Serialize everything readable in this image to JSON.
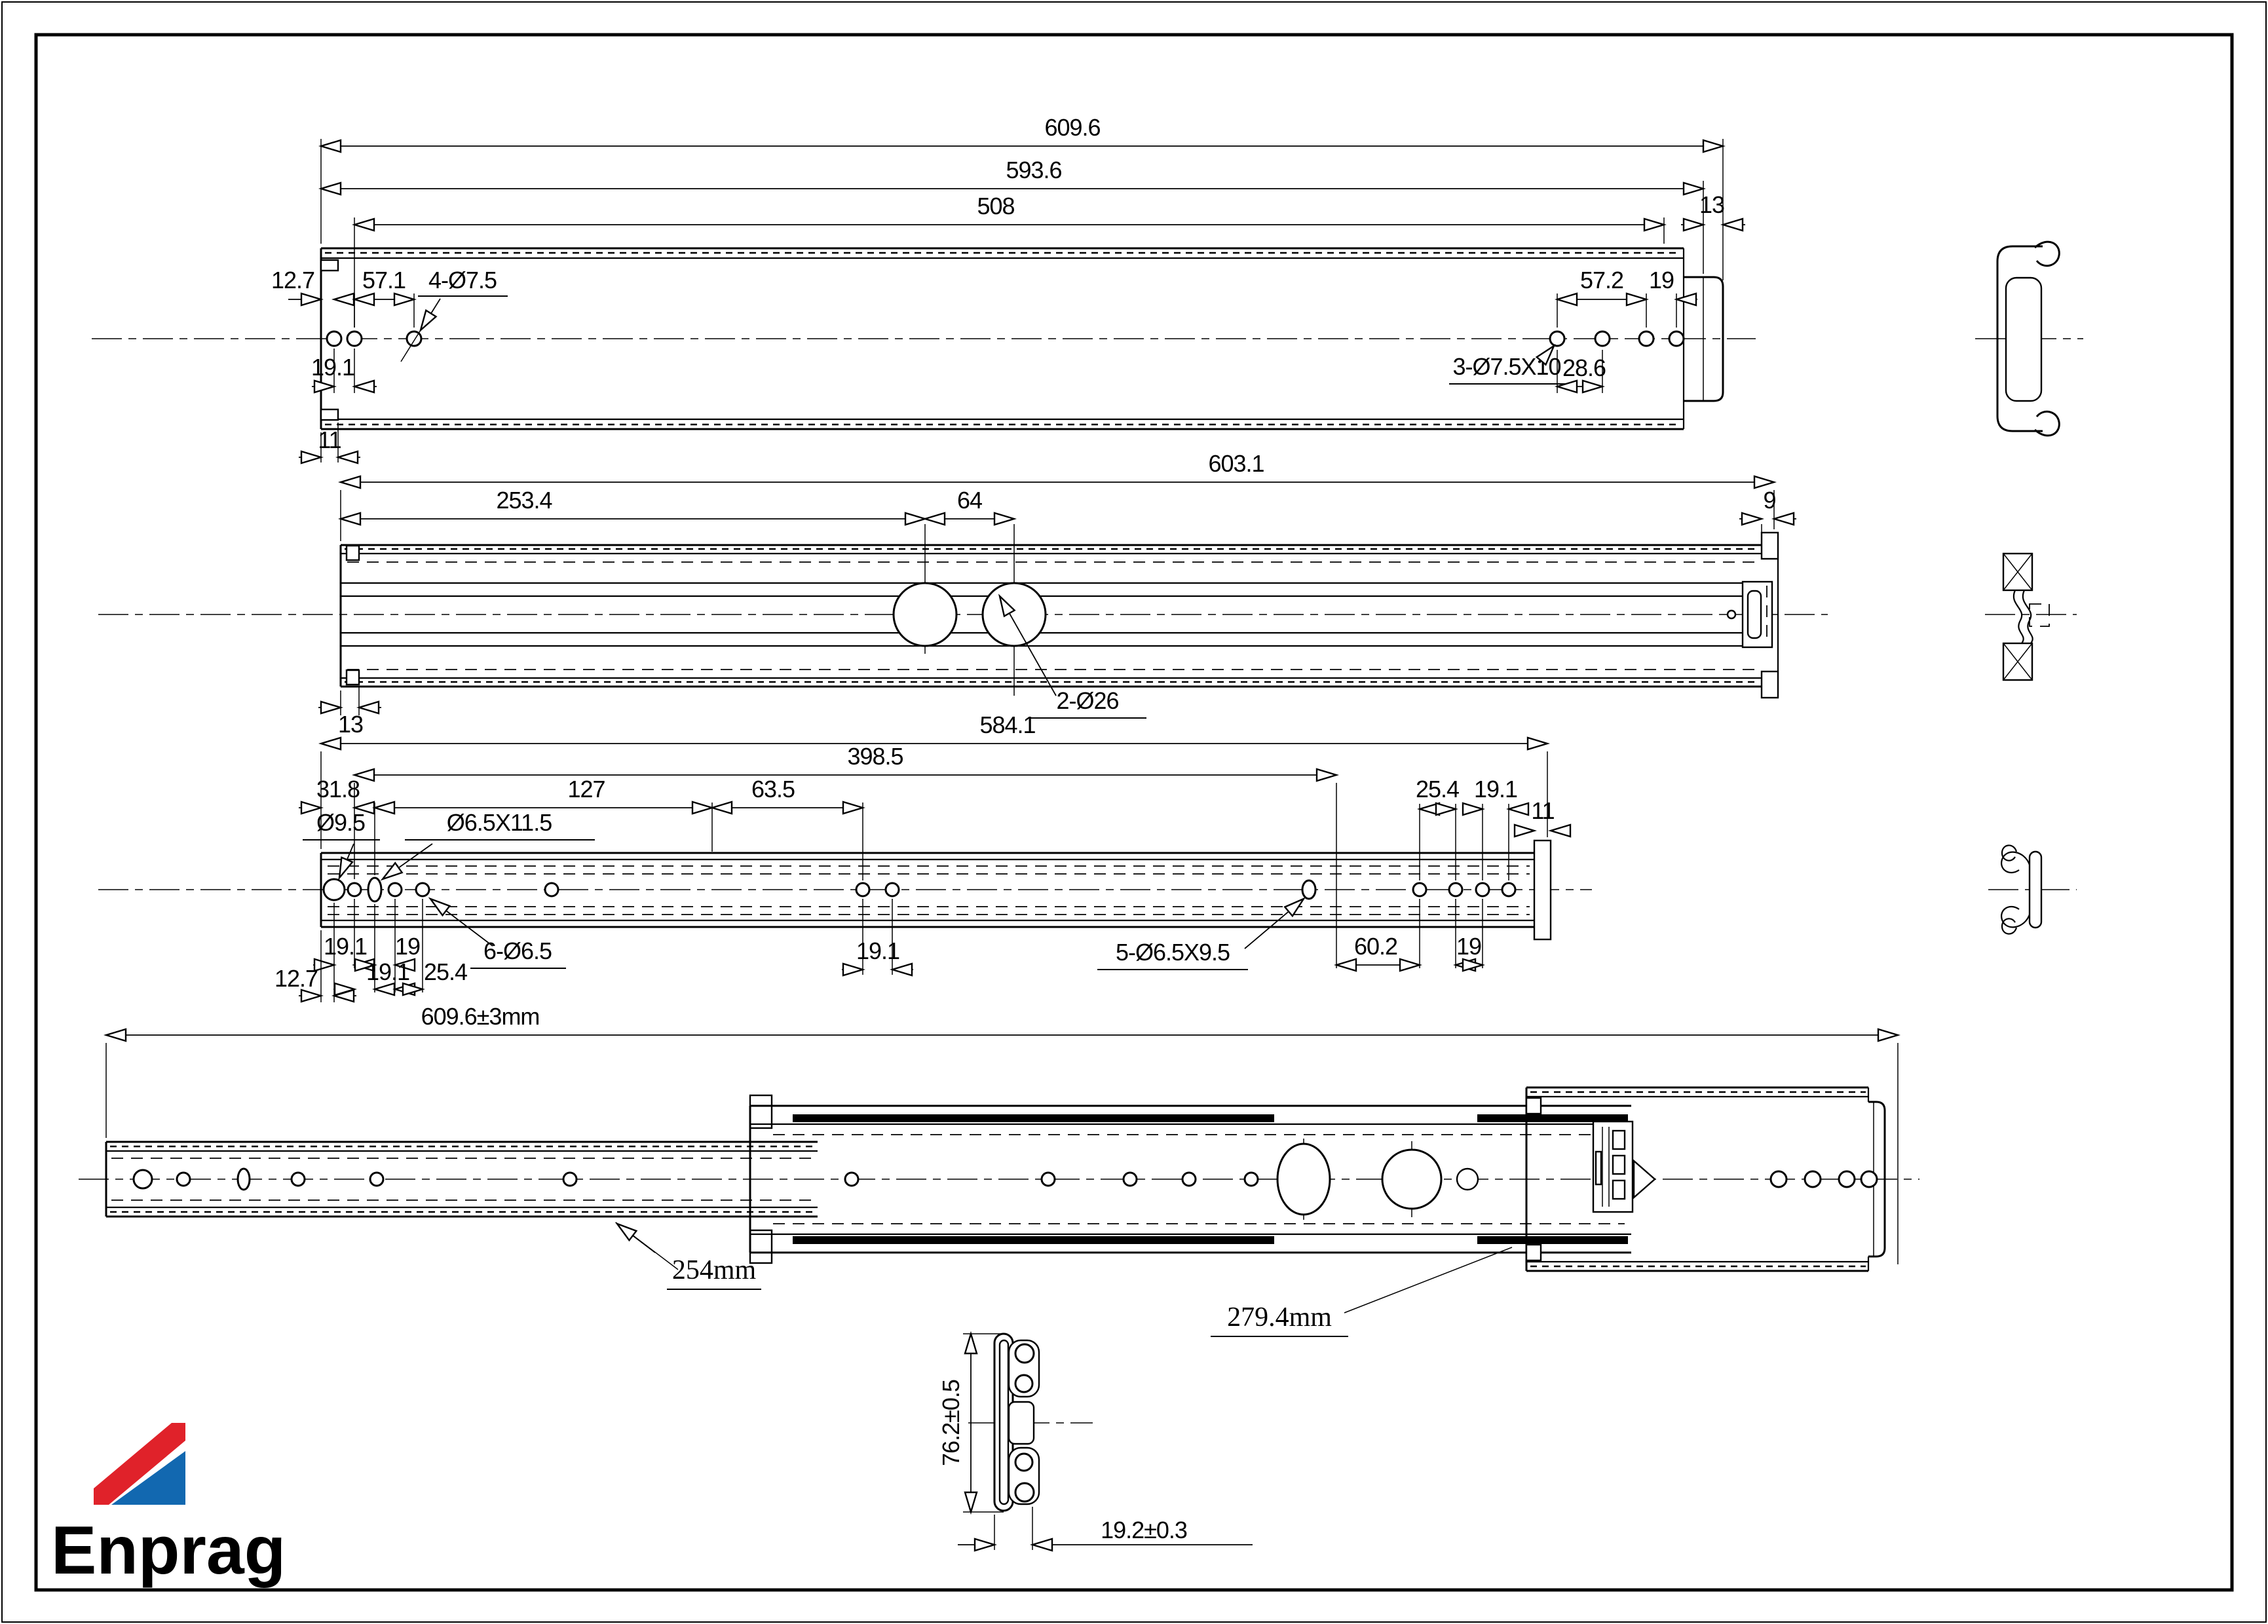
{
  "logo": {
    "text": "Enprag",
    "red": "#e0222a",
    "blue": "#1268b0"
  },
  "v1": {
    "total": "609.6",
    "body": "593.6",
    "span": "508",
    "step": "13",
    "edge": "12.7",
    "pitch": "57.1",
    "gap": "19.1",
    "holes": "4-Ø7.5",
    "pitch_r": "57.2",
    "gap_r": "19",
    "slots": "3-Ø7.5X10",
    "slot_gap": "28.6",
    "tab": "11"
  },
  "v2": {
    "total": "603.1",
    "span": "253.4",
    "pitch": "64",
    "step": "9",
    "holes": "2-Ø26",
    "tab": "13"
  },
  "v3": {
    "total": "584.1",
    "span": "398.5",
    "edge_top": "31.8",
    "pitch1": "127",
    "pitch2": "63.5",
    "hole": "Ø9.5",
    "slot": "Ø6.5X11.5",
    "gap1": "19.1",
    "gap2": "19.1",
    "gap3": "19",
    "gap4": "25.4",
    "holes": "6-Ø6.5",
    "edge": "12.7",
    "gap_mid": "19.1",
    "slots": "5-Ø6.5X9.5",
    "span_r": "60.2",
    "gap5": "19",
    "pitch_r": "25.4",
    "gap6": "19.1",
    "tab": "11"
  },
  "v4": {
    "total": "609.6±3mm",
    "closed": "254mm",
    "travel": "279.4mm"
  },
  "v5": {
    "height": "76.2±0.5",
    "width": "19.2±0.3"
  }
}
